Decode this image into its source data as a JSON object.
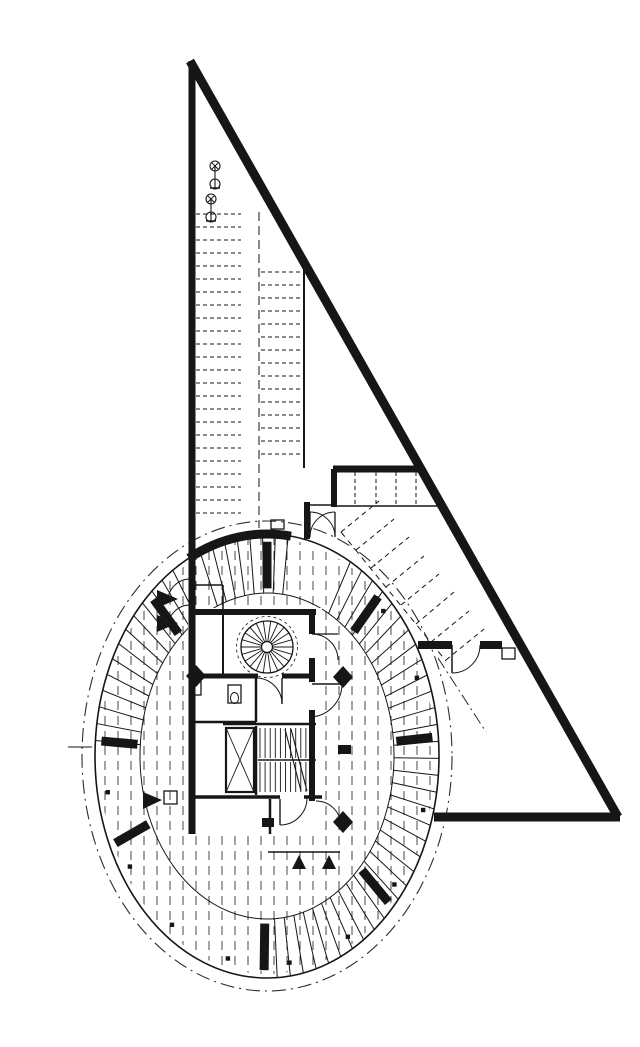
{
  "drawing": {
    "canvas": {
      "w": 640,
      "h": 1015,
      "background": "#ffffff"
    },
    "colors": {
      "ink": "#161616",
      "hatch": "#333333",
      "dashdot": "#2e2e2e"
    },
    "ellipse": {
      "cx": 227,
      "cy": 740,
      "outer_rx": 172,
      "outer_ry": 222,
      "dashdot_rx": 185,
      "dashdot_ry": 235,
      "inner_rx": 127,
      "inner_ry": 163,
      "hatch_rx": 168,
      "hatch_ry": 218
    },
    "hatch": {
      "x0": 65,
      "x1": 391,
      "step": 13,
      "y0": 520,
      "y1": 961,
      "dash": "9 6",
      "w": 0.9
    },
    "tread_arcs": [
      {
        "from": 184,
        "to": 241,
        "step": 4.4
      },
      {
        "from": 299,
        "to": 403,
        "step": 4.4
      },
      {
        "from": 47,
        "to": 90,
        "step": 4.4
      }
    ],
    "radial_stubs": {
      "angles": [
        43,
        91,
        156,
        184,
        227,
        270,
        312,
        355
      ],
      "s_in": 0.755,
      "s_out": 0.965,
      "w": 9
    },
    "top_arc": {
      "from": 243,
      "to": 278,
      "w": 9
    },
    "top_stalls": {
      "from": 247,
      "to": 277.2,
      "step": 4.3,
      "w": 1
    },
    "perimeter_dots": {
      "angles": [
        15,
        38,
        60,
        82,
        104,
        126,
        148,
        170,
        316,
        338
      ],
      "scale": 0.94,
      "size": 4.4
    },
    "walls": [
      [
        152,
        45,
        152,
        818,
        7
      ],
      [
        150,
        45,
        578,
        801,
        9
      ],
      [
        394,
        801,
        580,
        801,
        9
      ],
      [
        150,
        596,
        276,
        596,
        6
      ],
      [
        293,
        453,
        382,
        453,
        7
      ],
      [
        294,
        453,
        294,
        491,
        6
      ],
      [
        294,
        490,
        404,
        490,
        1.5
      ],
      [
        267,
        489,
        294,
        489,
        1.5
      ],
      [
        264,
        250,
        264,
        452,
        2
      ],
      [
        267,
        486,
        267,
        523,
        6
      ],
      [
        378,
        629,
        412,
        629,
        8
      ],
      [
        440,
        629,
        462,
        629,
        8
      ],
      [
        412,
        629,
        412,
        657,
        1.5
      ],
      [
        272,
        596,
        272,
        618,
        6
      ],
      [
        272,
        642,
        272,
        666,
        6
      ],
      [
        272,
        694,
        272,
        785,
        6
      ],
      [
        150,
        660,
        218,
        660,
        5
      ],
      [
        242,
        660,
        272,
        660,
        5
      ],
      [
        183,
        598,
        183,
        658,
        2
      ],
      [
        216,
        662,
        216,
        706,
        2.5
      ],
      [
        150,
        706,
        216,
        706,
        2.5
      ],
      [
        183,
        708,
        276,
        708,
        2.5
      ],
      [
        216,
        710,
        216,
        779,
        2.5
      ],
      [
        150,
        781,
        240,
        781,
        3.5
      ],
      [
        264,
        781,
        282,
        781,
        3.5
      ],
      [
        230,
        783,
        230,
        818,
        2.5
      ],
      [
        228,
        836,
        300,
        836,
        1.5
      ],
      [
        218,
        744,
        276,
        744,
        1.5
      ],
      [
        245,
        713,
        261,
        775,
        1.1
      ],
      [
        251,
        713,
        267,
        775,
        1.1
      ],
      [
        186,
        712,
        214,
        776,
        0.9
      ],
      [
        214,
        712,
        186,
        776,
        0.9
      ],
      [
        150,
        569,
        183,
        569,
        1.5
      ],
      [
        183,
        569,
        183,
        596,
        1.5
      ],
      [
        272,
        668,
        302,
        668,
        1.4
      ],
      [
        272,
        618,
        298,
        618,
        1.3
      ],
      [
        242,
        662,
        242,
        688,
        1.4
      ],
      [
        240,
        783,
        240,
        809,
        1.4
      ],
      [
        270,
        496,
        270,
        521,
        1.3
      ],
      [
        295,
        496,
        295,
        521,
        1.3
      ],
      [
        28,
        731,
        52,
        731,
        1.1
      ]
    ],
    "dashed_lines": [
      [
        219,
        196,
        219,
        512,
        1,
        "9 5"
      ],
      [
        315,
        456,
        315,
        489,
        1,
        "4 3"
      ],
      [
        336,
        456,
        336,
        489,
        1,
        "4 3"
      ],
      [
        356,
        456,
        356,
        489,
        1,
        "4 3"
      ],
      [
        376,
        456,
        376,
        489,
        1,
        "4 3"
      ],
      [
        301,
        516,
        339,
        485,
        1,
        "5 4"
      ],
      [
        316,
        534,
        354,
        503,
        1,
        "5 4"
      ],
      [
        331,
        552,
        369,
        521,
        1,
        "5 4"
      ],
      [
        346,
        571,
        384,
        540,
        1,
        "5 4"
      ],
      [
        361,
        589,
        399,
        558,
        1,
        "5 4"
      ],
      [
        376,
        608,
        414,
        576,
        1,
        "5 4"
      ],
      [
        391,
        626,
        429,
        595,
        1,
        "5 4"
      ],
      [
        406,
        644,
        444,
        613,
        1,
        "5 4"
      ],
      [
        301,
        516,
        406,
        645,
        1,
        "6 5"
      ],
      [
        398,
        642,
        446,
        716,
        0.9,
        "12 4 2 4"
      ]
    ],
    "stall_rows": [
      {
        "x1": 156,
        "x2": 201,
        "y0": 198,
        "y1": 499,
        "step": 13,
        "dash": "4 3"
      },
      {
        "x1": 221,
        "x2": 262,
        "y0": 256,
        "y1": 450,
        "step": 13,
        "dash": "4 3"
      }
    ],
    "white_rects": [
      [
        148,
        592,
        134,
        227
      ]
    ],
    "outline_rects": [
      [
        186,
        712,
        28,
        64,
        2.2
      ],
      [
        188,
        669,
        13,
        18,
        1.3
      ],
      [
        152,
        666,
        9,
        13,
        1.3
      ],
      [
        124,
        775,
        13,
        13,
        1.3
      ],
      [
        462,
        632,
        13,
        11,
        1.3
      ],
      [
        231,
        504,
        13,
        9,
        1.3
      ]
    ],
    "black_rects": [
      [
        222,
        802,
        12,
        9
      ],
      [
        298,
        729,
        13,
        9
      ]
    ],
    "fixture_ellipses": [
      [
        194.5,
        682,
        4,
        5.5
      ]
    ],
    "door_arcs": [
      "M 270,521 A 25 25 0 0 1 295,496",
      "M 295,521 A 25 25 0 0 0 270,496",
      "M 128,585 A 22 22 0 0 1 150,563",
      "M 128,611 A 22 22 0 0 1 150,589",
      "M 302,668 A 33 33 0 0 1 269,701",
      "M 272,618 A 26 26 0 0 1 298,644",
      "M 242,688 A 26 26 0 0 0 216,662",
      "M 412,657 A 28 28 0 0 0 440,629",
      "M 240,809 A 27 27 0 0 0 267,782",
      "M 276,785 A 25 25 0 0 1 301,810"
    ],
    "polygons": [
      [
        303,
        650,
        313,
        661,
        303,
        672,
        293,
        661
      ],
      [
        303,
        795,
        313,
        806,
        303,
        817,
        293,
        806
      ],
      [
        156,
        649,
        166,
        660,
        156,
        671,
        146,
        660
      ],
      [
        117,
        574,
        117,
        592,
        138,
        583
      ],
      [
        117,
        599,
        117,
        616,
        138,
        607
      ],
      [
        103,
        776,
        103,
        793,
        122,
        784
      ],
      [
        259,
        839,
        252,
        853,
        266,
        853
      ],
      [
        289,
        839,
        282,
        853,
        296,
        853
      ]
    ],
    "spiral_stair": {
      "cx": 227,
      "cy": 631,
      "r_outer": 26,
      "r_dash": 30.5,
      "r_inner": 5.5,
      "treads": 22
    },
    "main_stair": {
      "x0": 220,
      "x1": 271,
      "step": 5.1,
      "flights": [
        [
          712,
          742
        ],
        [
          746,
          776
        ]
      ]
    },
    "moto_icons": [
      {
        "x": 175,
        "y": 159
      },
      {
        "x": 171,
        "y": 192
      }
    ]
  }
}
